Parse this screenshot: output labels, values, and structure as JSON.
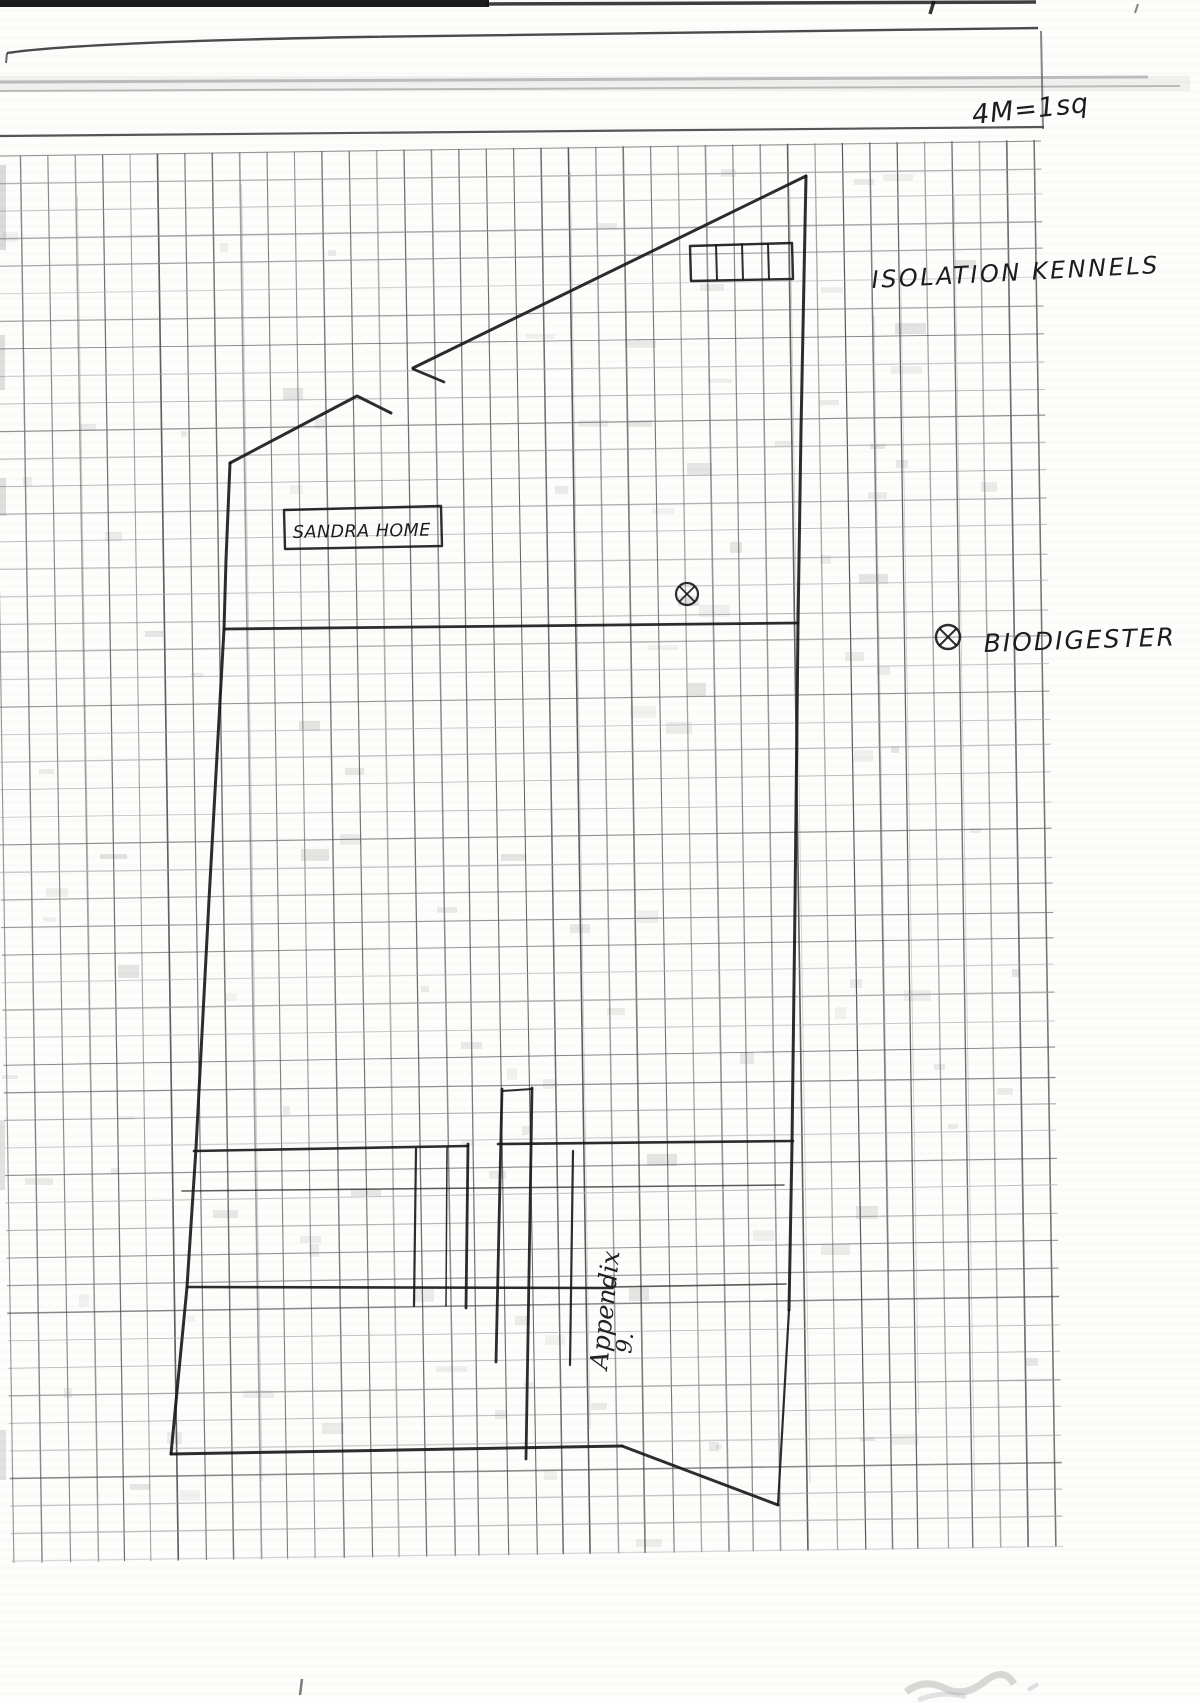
{
  "document": {
    "scale_note": "4M=1sq",
    "labels": {
      "isolation_kennels": "ISOLATION KENNELS",
      "sandra_home": "SANDRA HOME",
      "biodigester": "BIODIGESTER",
      "appendix_word": "Appendix",
      "appendix_number": "9."
    },
    "legend": {
      "biodigester_symbol": "circled-x"
    }
  }
}
